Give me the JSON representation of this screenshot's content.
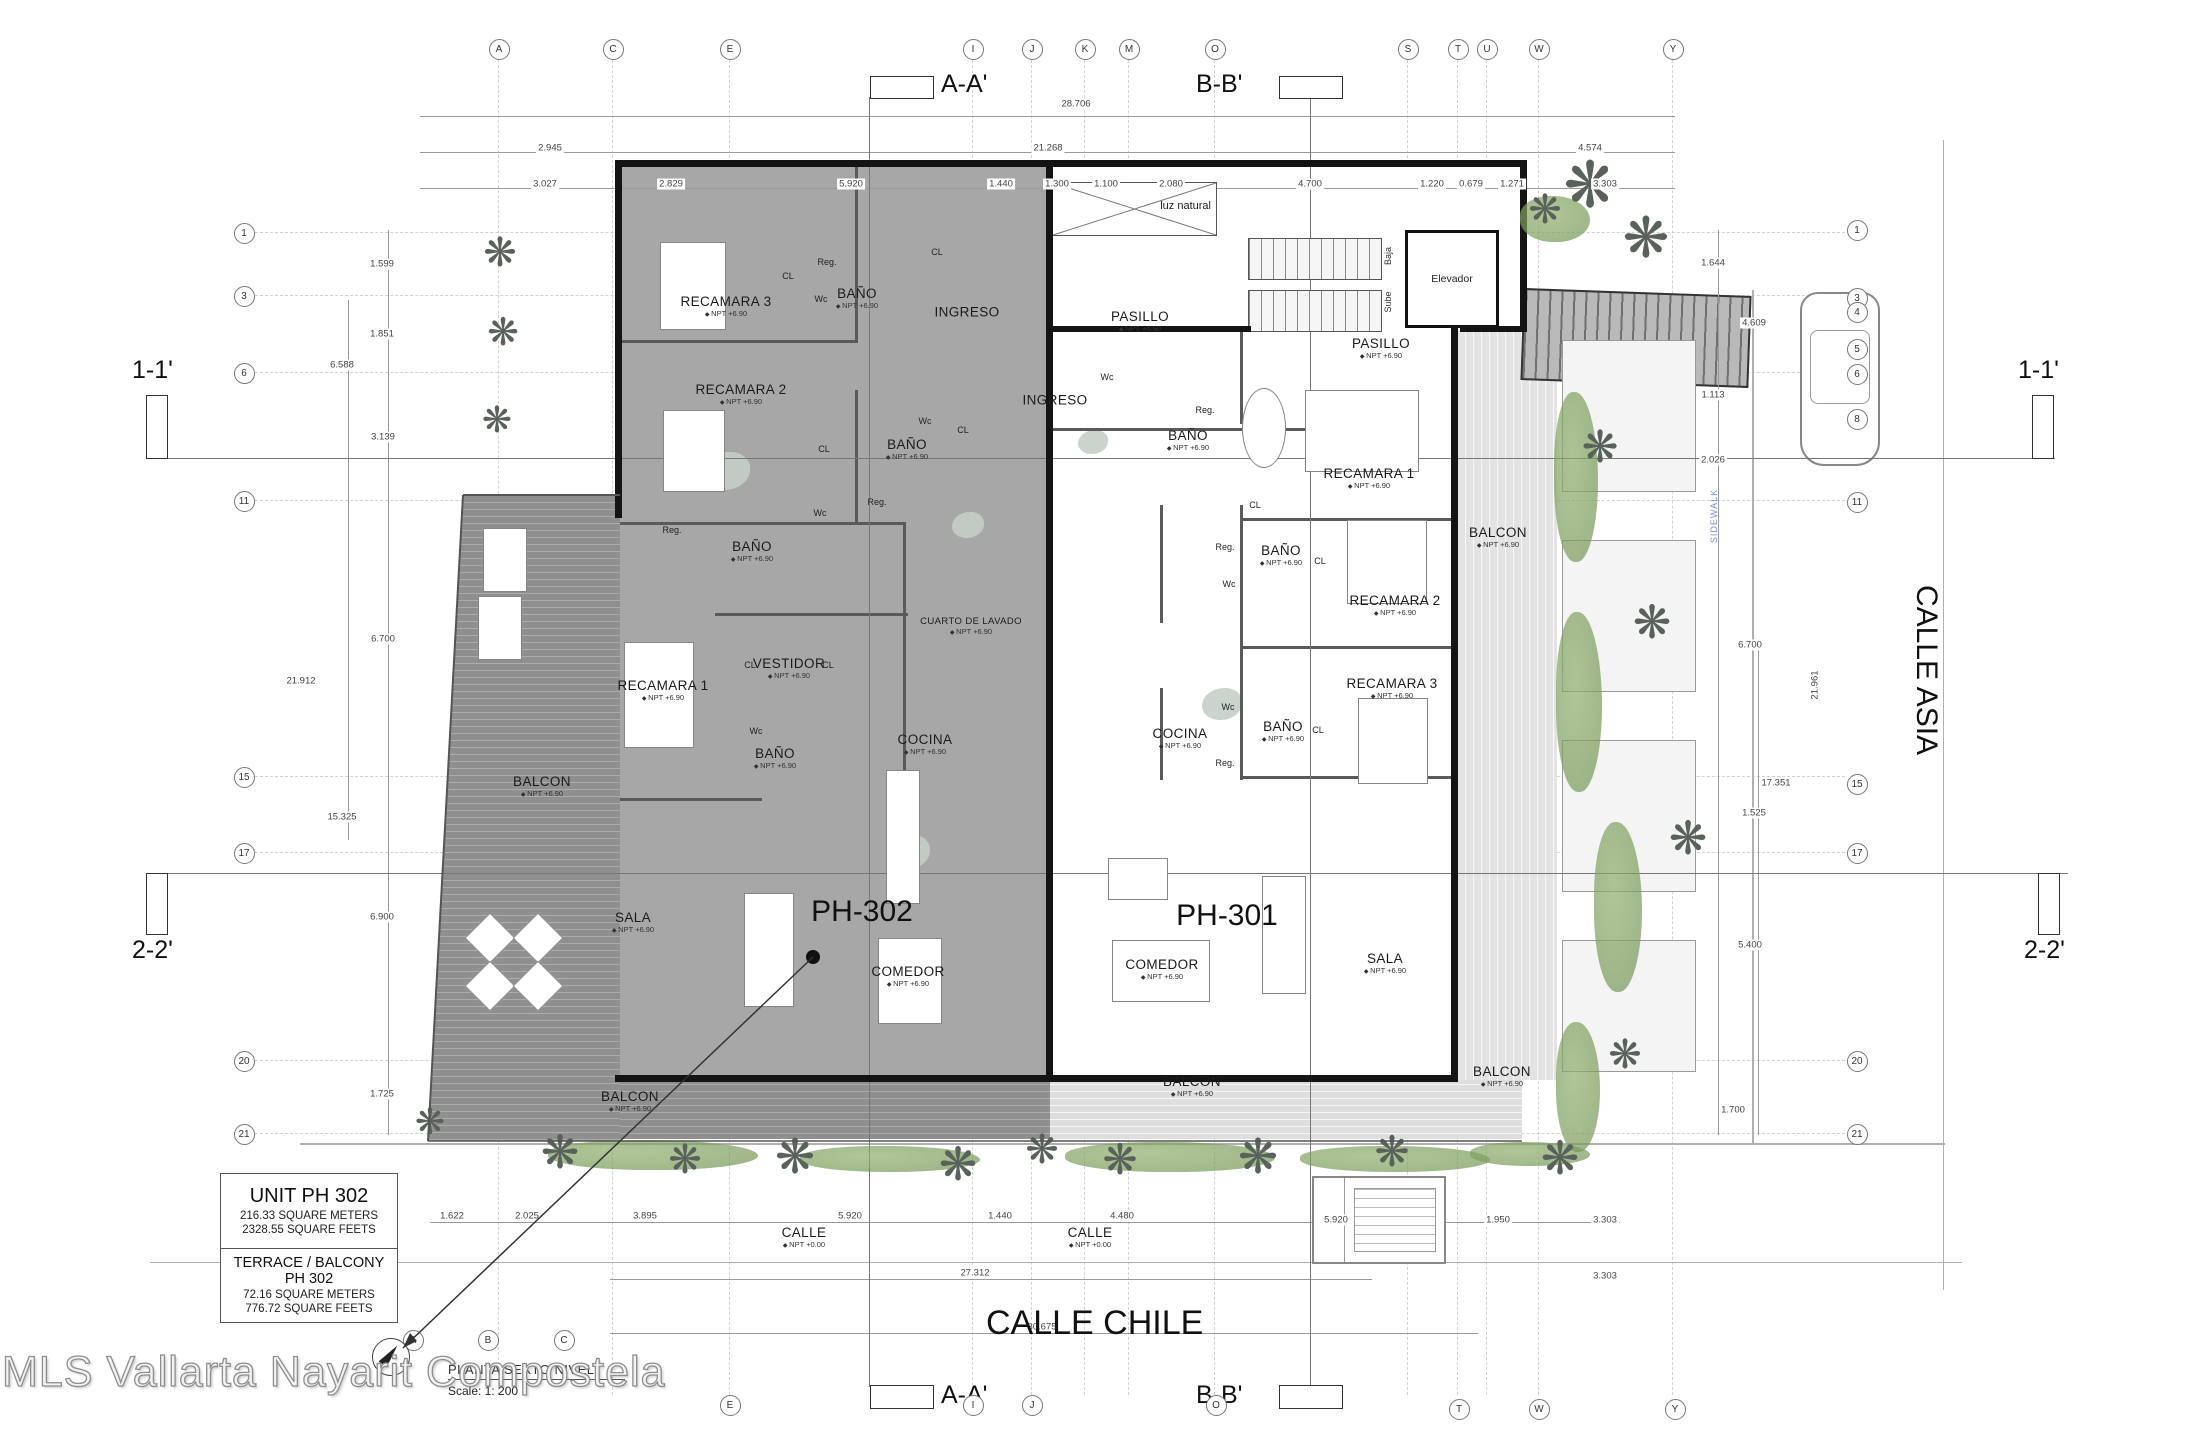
{
  "meta": {
    "watermark": "MLS Vallarta Nayarit Compostela",
    "plan_title": "PLANTA SEXTO NIVEL",
    "scale_label": "Scale:   1: 200"
  },
  "title_block": {
    "unit_title": "UNIT PH 302",
    "unit_sqm": "216.33  SQUARE METERS",
    "unit_sqft": "2328.55  SQUARE FEETS",
    "terrace_title": "TERRACE / BALCONY PH 302",
    "terrace_sqm": "72.16 SQUARE METERS",
    "terrace_sqft": "776.72  SQUARE FEETS"
  },
  "streets": {
    "bottom": "CALLE CHILE",
    "right": "CALLE ASIA"
  },
  "sections": {
    "aa": "A-A'",
    "bb": "B-B'",
    "s11": "1-1'",
    "s22": "2-2'"
  },
  "units": {
    "left": "PH-302",
    "right": "PH-301"
  },
  "core": {
    "elevator": "Elevador",
    "stair_down": "Baja",
    "stair_up": "Sube",
    "skylight": "luz natural",
    "sidewalk": "SIDEWALK"
  },
  "levels": {
    "floor": "NPT +6.90",
    "street": "NPT +0.00"
  },
  "palm_glyph": "❋",
  "grid": {
    "top": [
      {
        "t": "A",
        "x": 498
      },
      {
        "t": "C",
        "x": 612
      },
      {
        "t": "E",
        "x": 729
      },
      {
        "t": "I",
        "x": 972
      },
      {
        "t": "J",
        "x": 1031
      },
      {
        "t": "K",
        "x": 1084
      },
      {
        "t": "M",
        "x": 1128
      },
      {
        "t": "O",
        "x": 1214
      },
      {
        "t": "S",
        "x": 1407
      },
      {
        "t": "T",
        "x": 1457
      },
      {
        "t": "U",
        "x": 1486
      },
      {
        "t": "W",
        "x": 1538
      },
      {
        "t": "Y",
        "x": 1672
      }
    ],
    "bottom": [
      {
        "t": "A",
        "x": 412,
        "y": 1339
      },
      {
        "t": "B",
        "x": 487,
        "y": 1339
      },
      {
        "t": "C",
        "x": 563,
        "y": 1339
      },
      {
        "t": "E",
        "x": 729,
        "y": 1404
      },
      {
        "t": "I",
        "x": 972,
        "y": 1404
      },
      {
        "t": "J",
        "x": 1031,
        "y": 1404
      },
      {
        "t": "O",
        "x": 1215,
        "y": 1404
      },
      {
        "t": "T",
        "x": 1458,
        "y": 1408
      },
      {
        "t": "W",
        "x": 1538,
        "y": 1408
      },
      {
        "t": "Y",
        "x": 1674,
        "y": 1408
      }
    ],
    "left": [
      {
        "t": "1",
        "y": 232
      },
      {
        "t": "3",
        "y": 295
      },
      {
        "t": "6",
        "y": 372
      },
      {
        "t": "11",
        "y": 500
      },
      {
        "t": "15",
        "y": 776
      },
      {
        "t": "17",
        "y": 852
      },
      {
        "t": "20",
        "y": 1060
      },
      {
        "t": "21",
        "y": 1133
      }
    ],
    "right": [
      {
        "t": "1",
        "y": 229
      },
      {
        "t": "3",
        "y": 297
      },
      {
        "t": "4",
        "y": 311
      },
      {
        "t": "5",
        "y": 348
      },
      {
        "t": "6",
        "y": 373
      },
      {
        "t": "8",
        "y": 418
      },
      {
        "t": "11",
        "y": 501
      },
      {
        "t": "15",
        "y": 783
      },
      {
        "t": "17",
        "y": 852
      },
      {
        "t": "20",
        "y": 1060
      },
      {
        "t": "21",
        "y": 1133
      }
    ]
  },
  "dims": [
    {
      "t": "28.706",
      "x": 1076,
      "y": 104
    },
    {
      "t": "2.945",
      "x": 550,
      "y": 148
    },
    {
      "t": "21.268",
      "x": 1048,
      "y": 148
    },
    {
      "t": "4.574",
      "x": 1590,
      "y": 148
    },
    {
      "t": "3.027",
      "x": 545,
      "y": 184
    },
    {
      "t": "2.829",
      "x": 671,
      "y": 184
    },
    {
      "t": "5.920",
      "x": 851,
      "y": 184
    },
    {
      "t": "1.440",
      "x": 1001,
      "y": 184
    },
    {
      "t": "1.300",
      "x": 1057,
      "y": 184
    },
    {
      "t": "1.100",
      "x": 1106,
      "y": 184
    },
    {
      "t": "2.080",
      "x": 1171,
      "y": 184
    },
    {
      "t": "4.700",
      "x": 1310,
      "y": 184
    },
    {
      "t": "1.220",
      "x": 1432,
      "y": 184
    },
    {
      "t": "0.679",
      "x": 1471,
      "y": 184
    },
    {
      "t": "1.271",
      "x": 1512,
      "y": 184
    },
    {
      "t": "3.303",
      "x": 1605,
      "y": 184
    },
    {
      "t": "1.599",
      "x": 382,
      "y": 264
    },
    {
      "t": "1.851",
      "x": 382,
      "y": 334
    },
    {
      "t": "6.588",
      "x": 342,
      "y": 365
    },
    {
      "t": "3.139",
      "x": 383,
      "y": 437
    },
    {
      "t": "6.700",
      "x": 383,
      "y": 639
    },
    {
      "t": "21.912",
      "x": 301,
      "y": 681
    },
    {
      "t": "15.325",
      "x": 342,
      "y": 817
    },
    {
      "t": "6.900",
      "x": 382,
      "y": 917
    },
    {
      "t": "1.725",
      "x": 382,
      "y": 1094
    },
    {
      "t": "1.644",
      "x": 1713,
      "y": 263
    },
    {
      "t": "4.609",
      "x": 1754,
      "y": 323
    },
    {
      "t": "1.113",
      "x": 1713,
      "y": 395
    },
    {
      "t": "2.026",
      "x": 1713,
      "y": 460
    },
    {
      "t": "6.700",
      "x": 1750,
      "y": 645
    },
    {
      "t": "21.961",
      "x": 1815,
      "y": 685,
      "r": -90
    },
    {
      "t": "17.351",
      "x": 1776,
      "y": 783
    },
    {
      "t": "1.525",
      "x": 1754,
      "y": 813
    },
    {
      "t": "5.400",
      "x": 1750,
      "y": 945
    },
    {
      "t": "1.700",
      "x": 1733,
      "y": 1110
    },
    {
      "t": "1.622",
      "x": 452,
      "y": 1216
    },
    {
      "t": "2.025",
      "x": 527,
      "y": 1216
    },
    {
      "t": "3.895",
      "x": 645,
      "y": 1216
    },
    {
      "t": "5.920",
      "x": 850,
      "y": 1216
    },
    {
      "t": "1.440",
      "x": 1000,
      "y": 1216
    },
    {
      "t": "4.480",
      "x": 1122,
      "y": 1216
    },
    {
      "t": "5.920",
      "x": 1336,
      "y": 1220
    },
    {
      "t": "1.950",
      "x": 1498,
      "y": 1220
    },
    {
      "t": "3.303",
      "x": 1605,
      "y": 1220
    },
    {
      "t": "3.303",
      "x": 1605,
      "y": 1276
    },
    {
      "t": "27.312",
      "x": 975,
      "y": 1273
    },
    {
      "t": "30.675",
      "x": 1042,
      "y": 1327
    }
  ],
  "rooms": [
    {
      "t": "RECAMARA 3",
      "s": "NPT +6.90",
      "x": 726,
      "y": 306
    },
    {
      "t": "BAÑO",
      "s": "NPT +6.90",
      "x": 857,
      "y": 298
    },
    {
      "t": "INGRESO",
      "x": 967,
      "y": 312
    },
    {
      "t": "RECAMARA 2",
      "s": "NPT +6.90",
      "x": 741,
      "y": 394
    },
    {
      "t": "BAÑO",
      "s": "NPT +6.90",
      "x": 907,
      "y": 449
    },
    {
      "t": "BAÑO",
      "s": "NPT +6.90",
      "x": 752,
      "y": 551
    },
    {
      "t": "RECAMARA 1",
      "s": "NPT +6.90",
      "x": 663,
      "y": 690
    },
    {
      "t": "VESTIDOR",
      "s": "NPT +6.90",
      "x": 789,
      "y": 668
    },
    {
      "t": "BAÑO",
      "s": "NPT +6.90",
      "x": 775,
      "y": 758
    },
    {
      "t": "CUARTO DE LAVADO",
      "s": "NPT +6.90",
      "x": 971,
      "y": 626,
      "sm": 1
    },
    {
      "t": "COCINA",
      "s": "NPT +6.90",
      "x": 925,
      "y": 744
    },
    {
      "t": "SALA",
      "s": "NPT +6.90",
      "x": 633,
      "y": 922
    },
    {
      "t": "COMEDOR",
      "s": "NPT +6.90",
      "x": 908,
      "y": 976
    },
    {
      "t": "BALCON",
      "s": "NPT +6.90",
      "x": 542,
      "y": 786
    },
    {
      "t": "BALCON",
      "s": "NPT +6.90",
      "x": 630,
      "y": 1101
    },
    {
      "t": "INGRESO",
      "x": 1055,
      "y": 400
    },
    {
      "t": "PASILLO",
      "s": "NPT +6.90",
      "x": 1140,
      "y": 321
    },
    {
      "t": "PASILLO",
      "s": "NPT +6.90",
      "x": 1381,
      "y": 348
    },
    {
      "t": "BAÑO",
      "s": "NPT +6.90",
      "x": 1188,
      "y": 440
    },
    {
      "t": "RECAMARA 1",
      "s": "NPT +6.90",
      "x": 1369,
      "y": 478
    },
    {
      "t": "BAÑO",
      "s": "NPT +6.90",
      "x": 1281,
      "y": 555
    },
    {
      "t": "RECAMARA 2",
      "s": "NPT +6.90",
      "x": 1395,
      "y": 605
    },
    {
      "t": "BALCON",
      "s": "NPT +6.90",
      "x": 1498,
      "y": 537
    },
    {
      "t": "RECAMARA 3",
      "s": "NPT +6.90",
      "x": 1392,
      "y": 688
    },
    {
      "t": "BAÑO",
      "s": "NPT +6.90",
      "x": 1283,
      "y": 731
    },
    {
      "t": "COCINA",
      "s": "NPT +6.90",
      "x": 1180,
      "y": 738
    },
    {
      "t": "COMEDOR",
      "s": "NPT +6.90",
      "x": 1162,
      "y": 969
    },
    {
      "t": "SALA",
      "s": "NPT +6.90",
      "x": 1385,
      "y": 963
    },
    {
      "t": "BALCON",
      "s": "NPT +6.90",
      "x": 1192,
      "y": 1086
    },
    {
      "t": "BALCON",
      "s": "NPT +6.90",
      "x": 1502,
      "y": 1076
    },
    {
      "t": "CALLE",
      "s": "NPT +0.00",
      "x": 804,
      "y": 1237
    },
    {
      "t": "CALLE",
      "s": "NPT +0.00",
      "x": 1090,
      "y": 1237
    }
  ],
  "fixtures": [
    {
      "t": "CL",
      "x": 788,
      "y": 276
    },
    {
      "t": "CL",
      "x": 937,
      "y": 252
    },
    {
      "t": "CL",
      "x": 963,
      "y": 430
    },
    {
      "t": "CL",
      "x": 824,
      "y": 449
    },
    {
      "t": "CL",
      "x": 750,
      "y": 665
    },
    {
      "t": "CL",
      "x": 828,
      "y": 665
    },
    {
      "t": "CL",
      "x": 1320,
      "y": 561
    },
    {
      "t": "CL",
      "x": 1255,
      "y": 505
    },
    {
      "t": "CL",
      "x": 1318,
      "y": 730
    },
    {
      "t": "Wc",
      "x": 821,
      "y": 299
    },
    {
      "t": "Wc",
      "x": 925,
      "y": 421
    },
    {
      "t": "Wc",
      "x": 820,
      "y": 513
    },
    {
      "t": "Wc",
      "x": 756,
      "y": 731
    },
    {
      "t": "Wc",
      "x": 1107,
      "y": 377
    },
    {
      "t": "Wc",
      "x": 1229,
      "y": 584
    },
    {
      "t": "Wc",
      "x": 1228,
      "y": 707
    },
    {
      "t": "Reg.",
      "x": 827,
      "y": 262
    },
    {
      "t": "Reg.",
      "x": 877,
      "y": 502
    },
    {
      "t": "Reg.",
      "x": 672,
      "y": 530
    },
    {
      "t": "Reg.",
      "x": 1205,
      "y": 410
    },
    {
      "t": "Reg.",
      "x": 1225,
      "y": 547
    },
    {
      "t": "Reg.",
      "x": 1225,
      "y": 763
    }
  ]
}
